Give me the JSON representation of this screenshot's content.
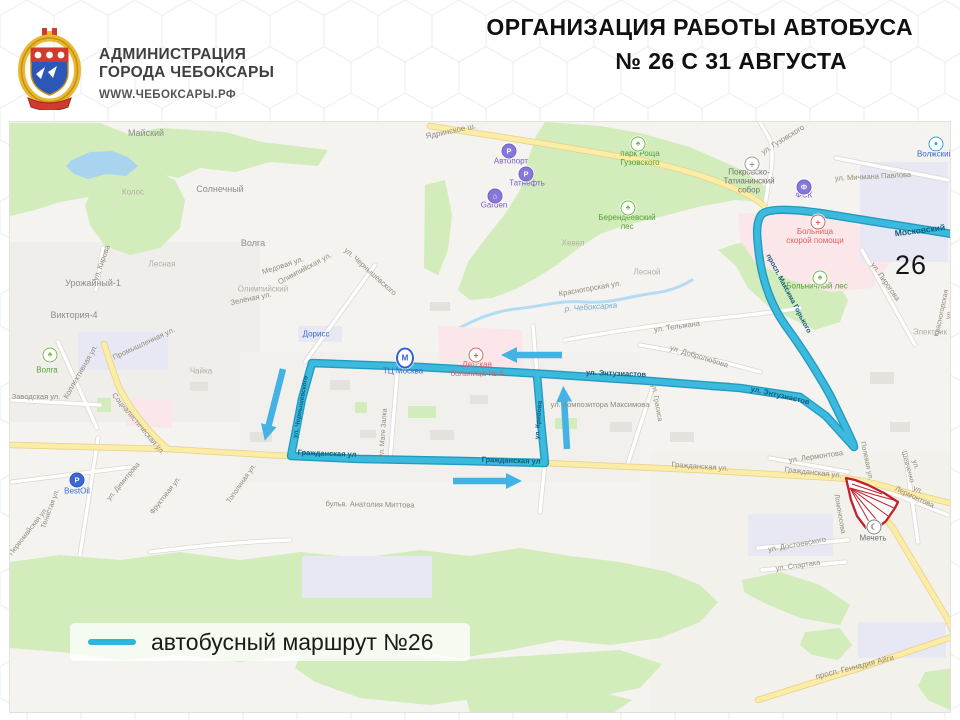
{
  "header": {
    "org_line1": "АДМИНИСТРАЦИЯ",
    "org_line2": "ГОРОДА ЧЕБОКСАРЫ",
    "site": "WWW.ЧЕБОКСАРЫ.РФ",
    "title_line1": "ОРГАНИЗАЦИЯ РАБОТЫ АВТОБУСА",
    "title_line2": "№ 26 С 31 АВГУСТА"
  },
  "legend": {
    "label": "автобусный маршрут №26"
  },
  "colors": {
    "route": "#35b7da",
    "route_casing": "#1795bd",
    "arrow": "#44b2e4",
    "closure_red": "#c2202a",
    "road_yellow": "#fceda6",
    "park_green": "#d2ecbb",
    "water_blue": "#a9d4ef"
  },
  "map": {
    "route_number_badge": "26",
    "labels": [
      {
        "t": "Майский",
        "x": 136,
        "y": 11,
        "r": 0,
        "c": "place"
      },
      {
        "t": "Солнечный",
        "x": 210,
        "y": 67,
        "r": 0,
        "c": "place"
      },
      {
        "t": "Колос",
        "x": 123,
        "y": 71,
        "r": 0,
        "c": "place-light"
      },
      {
        "t": "Волга",
        "x": 243,
        "y": 121,
        "r": 0,
        "c": "place"
      },
      {
        "t": "Лесная",
        "x": 152,
        "y": 143,
        "r": 0,
        "c": "place-light"
      },
      {
        "t": "Урожайный-1",
        "x": 83,
        "y": 161,
        "r": 0,
        "c": "place"
      },
      {
        "t": "Виктория-4",
        "x": 64,
        "y": 193,
        "r": 0,
        "c": "place"
      },
      {
        "t": "Олимпийский",
        "x": 253,
        "y": 168,
        "r": 0,
        "c": "place-light"
      },
      {
        "t": "Чайка",
        "x": 191,
        "y": 250,
        "r": 0,
        "c": "place-light"
      },
      {
        "t": "Хевел",
        "x": 563,
        "y": 122,
        "r": 0,
        "c": "place-light"
      },
      {
        "t": "Лесной",
        "x": 637,
        "y": 151,
        "r": 0,
        "c": "place-light"
      },
      {
        "t": "Электрик",
        "x": 920,
        "y": 211,
        "r": 0,
        "c": "place-light"
      },
      {
        "t": "ул. Кирова",
        "x": 92,
        "y": 141,
        "r": -70,
        "c": "street"
      },
      {
        "t": "Медовая ул.",
        "x": 273,
        "y": 144,
        "r": -18,
        "c": "street"
      },
      {
        "t": "Олимпийская ул.",
        "x": 295,
        "y": 147,
        "r": -28,
        "c": "street"
      },
      {
        "t": "Зелёная ул.",
        "x": 241,
        "y": 177,
        "r": -12,
        "c": "street"
      },
      {
        "t": "ул. Чернышевского",
        "x": 360,
        "y": 150,
        "r": 42,
        "c": "street"
      },
      {
        "t": "Ядринское ш.",
        "x": 441,
        "y": 10,
        "r": -12,
        "c": "street",
        "s": 8
      },
      {
        "t": "ул. Гузовского",
        "x": 773,
        "y": 18,
        "r": -32,
        "c": "street"
      },
      {
        "t": "ул. Мичмана Павлова",
        "x": 863,
        "y": 55,
        "r": -3,
        "c": "street"
      },
      {
        "t": "ул. Пирогова",
        "x": 875,
        "y": 160,
        "r": 55,
        "c": "street"
      },
      {
        "t": "Красногорская ул.",
        "x": 580,
        "y": 167,
        "r": -10,
        "c": "street"
      },
      {
        "t": "Красногорская ул.",
        "x": 936,
        "y": 192,
        "r": -78,
        "c": "street",
        "s": 7
      },
      {
        "t": "ул. Тельмана",
        "x": 667,
        "y": 205,
        "r": -8,
        "c": "street"
      },
      {
        "t": "ул. Добролюбова",
        "x": 689,
        "y": 235,
        "r": 17,
        "c": "street"
      },
      {
        "t": "ул. Композитора Максимова",
        "x": 590,
        "y": 283,
        "r": 0,
        "c": "street"
      },
      {
        "t": "ул. Грасиса",
        "x": 646,
        "y": 281,
        "r": 80,
        "c": "street",
        "s": 7
      },
      {
        "t": "ул. Мате Залка",
        "x": 374,
        "y": 311,
        "r": -86,
        "c": "street",
        "s": 7
      },
      {
        "t": "Гражданская ул.",
        "x": 690,
        "y": 345,
        "r": 4,
        "c": "street"
      },
      {
        "t": "Гражданская ул.",
        "x": 803,
        "y": 351,
        "r": 6,
        "c": "street"
      },
      {
        "t": "бульв. Анатолия Миттова",
        "x": 360,
        "y": 383,
        "r": 1,
        "c": "street"
      },
      {
        "t": "ул. Лермонтова",
        "x": 806,
        "y": 335,
        "r": -8,
        "c": "street"
      },
      {
        "t": "ул. Лермонтова",
        "x": 906,
        "y": 372,
        "r": 25,
        "c": "street"
      },
      {
        "t": "Полевая ул.",
        "x": 856,
        "y": 339,
        "r": 78,
        "c": "street",
        "s": 7
      },
      {
        "t": "ул. Шевченко",
        "x": 901,
        "y": 344,
        "r": 75,
        "c": "street",
        "s": 7
      },
      {
        "t": "Ломоносова",
        "x": 829,
        "y": 392,
        "r": 80,
        "c": "street",
        "s": 7
      },
      {
        "t": "ул. Достоевского",
        "x": 787,
        "y": 423,
        "r": -10,
        "c": "street"
      },
      {
        "t": "ул. Спартака",
        "x": 788,
        "y": 444,
        "r": -8,
        "c": "street"
      },
      {
        "t": "просп. Геннадия Айги",
        "x": 845,
        "y": 546,
        "r": -14,
        "c": "street",
        "s": 8
      },
      {
        "t": "Заводская ул.",
        "x": 26,
        "y": 275,
        "r": 0,
        "c": "street"
      },
      {
        "t": "Коллективная ул.",
        "x": 71,
        "y": 250,
        "r": -60,
        "c": "street"
      },
      {
        "t": "Промышленная ул.",
        "x": 134,
        "y": 222,
        "r": -25,
        "c": "street"
      },
      {
        "t": "Социалистическая ул.",
        "x": 128,
        "y": 302,
        "r": 50,
        "c": "street"
      },
      {
        "t": "Тенистая ул.",
        "x": 41,
        "y": 387,
        "r": -70,
        "c": "street",
        "s": 7
      },
      {
        "t": "Первомайская ул.",
        "x": 19,
        "y": 410,
        "r": -52,
        "c": "street",
        "s": 7
      },
      {
        "t": "ул. Димитрова",
        "x": 114,
        "y": 360,
        "r": -50,
        "c": "street",
        "s": 7
      },
      {
        "t": "Фруктовая ул.",
        "x": 156,
        "y": 374,
        "r": -52,
        "c": "street",
        "s": 7
      },
      {
        "t": "Тополиная ул.",
        "x": 232,
        "y": 362,
        "r": -55,
        "c": "street",
        "s": 7
      },
      {
        "t": "р. Чебоксарка",
        "x": 581,
        "y": 186,
        "r": -4,
        "c": "water"
      },
      {
        "t": "Московский",
        "x": 910,
        "y": 109,
        "r": -7,
        "c": "on-route",
        "s": 8.5
      },
      {
        "t": "ул. Энтузиастов",
        "x": 606,
        "y": 252,
        "r": 2,
        "c": "on-route"
      },
      {
        "t": "ул. Энтузиастов",
        "x": 770,
        "y": 274,
        "r": 13,
        "c": "on-route"
      },
      {
        "t": "просп. Максима Горького",
        "x": 778,
        "y": 172,
        "r": 62,
        "c": "on-route",
        "s": 7
      },
      {
        "t": "ул. Чернышевского",
        "x": 291,
        "y": 285,
        "r": -80,
        "c": "on-route",
        "s": 6.5
      },
      {
        "t": "ул. Кривова",
        "x": 529,
        "y": 298,
        "r": -86,
        "c": "on-route",
        "s": 6.5
      },
      {
        "t": "Гражданская ул",
        "x": 317,
        "y": 332,
        "r": 2,
        "c": "on-route"
      },
      {
        "t": "Гражданская ул",
        "x": 501,
        "y": 339,
        "r": 2,
        "c": "on-route"
      },
      {
        "t": "26",
        "x": 901,
        "y": 143,
        "r": 0,
        "c": "route-number"
      },
      {
        "t": "парк Роща\nГузовского",
        "x": 630,
        "y": 37,
        "r": 0,
        "c": "poi-green"
      },
      {
        "t": "Берендеевский\nлес",
        "x": 617,
        "y": 101,
        "r": 0,
        "c": "poi-green"
      },
      {
        "t": "Больничный лес",
        "x": 807,
        "y": 165,
        "r": 0,
        "c": "poi-green"
      },
      {
        "t": "Волга",
        "x": 37,
        "y": 249,
        "r": 0,
        "c": "poi-green"
      },
      {
        "t": "Больница\nскорой помощи",
        "x": 805,
        "y": 115,
        "r": 0,
        "c": "poi-red"
      },
      {
        "t": "Детская\nбольница № 4",
        "x": 467,
        "y": 248,
        "r": 0,
        "c": "poi-red"
      },
      {
        "t": "ТЦ Москва",
        "x": 393,
        "y": 250,
        "r": 0,
        "c": "poi-blue"
      },
      {
        "t": "Дорисс",
        "x": 306,
        "y": 213,
        "r": 0,
        "c": "poi-blue"
      },
      {
        "t": "BestOil",
        "x": 67,
        "y": 370,
        "r": 0,
        "c": "poi-blue"
      },
      {
        "t": "Волжский",
        "x": 925,
        "y": 33,
        "r": 0,
        "c": "poi-blue"
      },
      {
        "t": "Автопорт",
        "x": 501,
        "y": 40,
        "r": 0,
        "c": "poi-purple"
      },
      {
        "t": "Татнефть",
        "x": 517,
        "y": 62,
        "r": 0,
        "c": "poi-purple"
      },
      {
        "t": "Garden",
        "x": 484,
        "y": 84,
        "r": 0,
        "c": "poi-purple"
      },
      {
        "t": "ФСК",
        "x": 794,
        "y": 74,
        "r": 0,
        "c": "poi-purple"
      },
      {
        "t": "Покровско-\nТатианинский\nсобор",
        "x": 739,
        "y": 60,
        "r": 0,
        "c": "poi-dark"
      },
      {
        "t": "Мечеть",
        "x": 863,
        "y": 417,
        "r": 0,
        "c": "poi-dark"
      }
    ],
    "pois": [
      {
        "type": "tree",
        "glyph": "♣",
        "x": 40,
        "y": 233,
        "name": "park-icon"
      },
      {
        "type": "tree",
        "glyph": "♣",
        "x": 628,
        "y": 22,
        "name": "park-icon"
      },
      {
        "type": "tree",
        "glyph": "♣",
        "x": 618,
        "y": 86,
        "name": "park-icon"
      },
      {
        "type": "tree",
        "glyph": "♣",
        "x": 810,
        "y": 156,
        "name": "park-icon"
      },
      {
        "type": "red-cross",
        "glyph": "+",
        "x": 466,
        "y": 233,
        "name": "hospital-icon"
      },
      {
        "type": "red-cross",
        "glyph": "+",
        "x": 808,
        "y": 100,
        "name": "hospital-icon"
      },
      {
        "type": "gray-cross",
        "glyph": "+",
        "x": 742,
        "y": 42,
        "name": "church-icon"
      },
      {
        "type": "tc",
        "glyph": "М",
        "x": 395,
        "y": 236,
        "name": "mall-icon"
      },
      {
        "type": "purple",
        "glyph": "P",
        "x": 499,
        "y": 29,
        "name": "parking-icon"
      },
      {
        "type": "purple",
        "glyph": "P",
        "x": 516,
        "y": 52,
        "name": "fuel-icon"
      },
      {
        "type": "purple",
        "glyph": "⌂",
        "x": 485,
        "y": 74,
        "name": "hotel-icon"
      },
      {
        "type": "purple",
        "glyph": "Ф",
        "x": 794,
        "y": 65,
        "name": "sport-icon"
      },
      {
        "type": "blue-fill",
        "glyph": "P",
        "x": 67,
        "y": 358,
        "name": "fuel-icon"
      },
      {
        "type": "blue-ring",
        "glyph": "●",
        "x": 926,
        "y": 22,
        "name": "shop-icon"
      },
      {
        "type": "mosque",
        "glyph": "☾",
        "x": 864,
        "y": 405,
        "name": "mosque-icon"
      }
    ]
  }
}
